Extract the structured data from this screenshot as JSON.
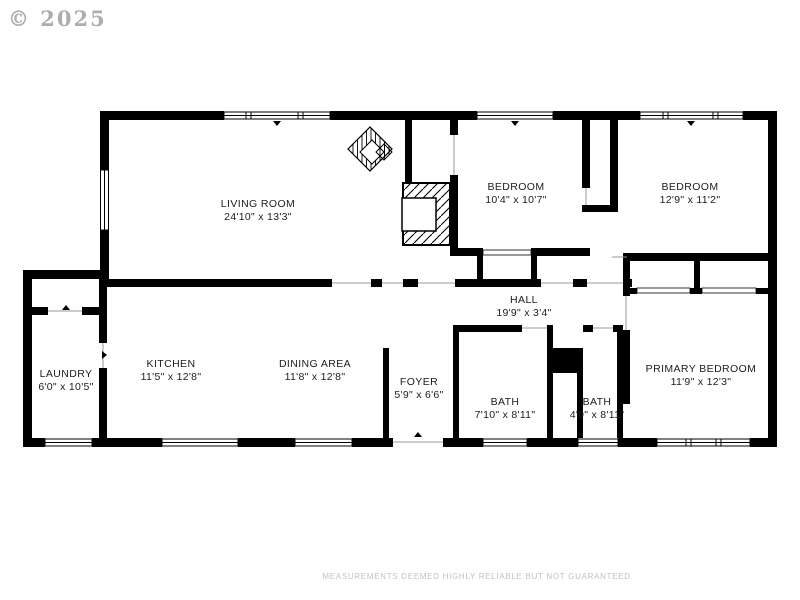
{
  "watermark": "© 2025",
  "disclaimer": "MEASUREMENTS DEEMED HIGHLY RELIABLE BUT NOT GUARANTEED.",
  "colors": {
    "walls": "#000000",
    "watermark": "#adadad",
    "disclaimer": "#c2c2c2",
    "background": "#ffffff"
  },
  "symbols": [
    "fireplace-hatch",
    "stove-diamond",
    "window",
    "door-opening"
  ],
  "rooms": {
    "living_room": {
      "name": "LIVING ROOM",
      "dims": "24'10\" x 13'3\""
    },
    "bedroom_top_middle": {
      "name": "BEDROOM",
      "dims": "10'4\" x 10'7\""
    },
    "bedroom_top_right": {
      "name": "BEDROOM",
      "dims": "12'9\" x 11'2\""
    },
    "hall": {
      "name": "HALL",
      "dims": "19'9\" x 3'4\""
    },
    "laundry": {
      "name": "LAUNDRY",
      "dims": "6'0\" x 10'5\""
    },
    "kitchen": {
      "name": "KITCHEN",
      "dims": "11'5\" x 12'8\""
    },
    "dining_area": {
      "name": "DINING AREA",
      "dims": "11'8\" x 12'8\""
    },
    "foyer": {
      "name": "FOYER",
      "dims": "5'9\" x 6'6\""
    },
    "bath_left": {
      "name": "BATH",
      "dims": "7'10\" x 8'11\""
    },
    "bath_right": {
      "name": "BATH",
      "dims": "4'9\" x 8'11\""
    },
    "primary_bedroom": {
      "name": "PRIMARY BEDROOM",
      "dims": "11'9\" x 12'3\""
    }
  }
}
